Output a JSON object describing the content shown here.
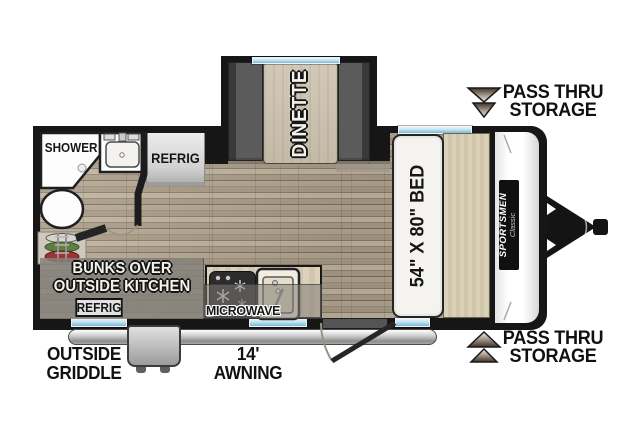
{
  "colors": {
    "wall": "#161616",
    "window_blue": "#9fd0e4",
    "wood_light": "#b5a893",
    "wood_dark": "#7e7260",
    "bench_gray": "#5b5b5b",
    "table_tan": "#cbc2b0",
    "headboard_tan": "#d7cdb3",
    "overlay_gray": "#87837c",
    "ladder_green": "#5d7f41",
    "ladder_red": "#9c3434"
  },
  "fixtures": {
    "shower": "SHOWER",
    "refrigerator": "REFRIG",
    "dinette": "DINETTE",
    "bed": "54\" X 80\" BED",
    "microwave": "MICROWAVE",
    "bunks_line1": "BUNKS OVER",
    "bunks_line2": "OUTSIDE KITCHEN",
    "outside_refrigerator": "REFRIG"
  },
  "brand": {
    "name": "SPORTSMEN",
    "series": "Classic"
  },
  "callouts": {
    "pass_thru_top": {
      "line1": "PASS THRU",
      "line2": "STORAGE"
    },
    "pass_thru_bottom": {
      "line1": "PASS THRU",
      "line2": "STORAGE"
    },
    "griddle": {
      "line1": "OUTSIDE",
      "line2": "GRIDDLE"
    },
    "awning": {
      "line1": "14'",
      "line2": "AWNING"
    }
  }
}
